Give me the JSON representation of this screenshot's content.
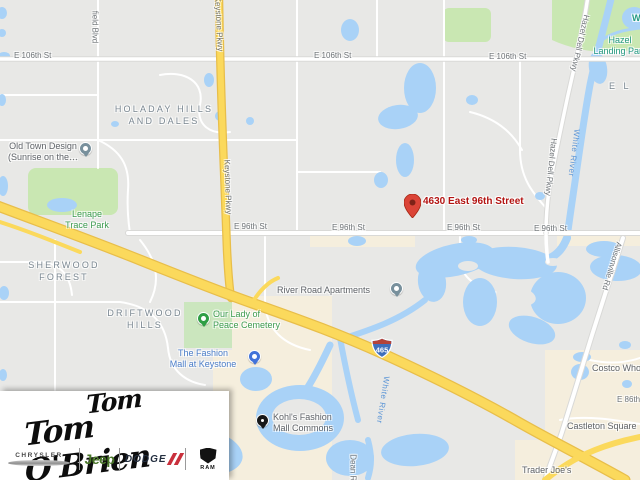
{
  "map": {
    "marker_address": "4630 East 96th Street",
    "neighborhoods": {
      "holaday": {
        "line1": "HOLADAY HILLS",
        "line2": "AND DALES"
      },
      "sherwood": {
        "line1": "SHERWOOD",
        "line2": "FOREST"
      },
      "driftwood": {
        "line1": "DRIFTWOOD",
        "line2": "HILLS"
      },
      "partial_el": "E L"
    },
    "streets": {
      "e106": "E 106th St",
      "e96": "E 96th St",
      "e86": "E 86th St",
      "keystone": "Keystone Pkwy",
      "field_blvd": "field Blvd",
      "hazel_dell": "Hazel Dell Pkwy",
      "allisonville": "Allisonville Rd",
      "dean": "Dean Rd",
      "white_river": "White River",
      "i465": "465"
    },
    "pois": {
      "old_town": {
        "line1": "Old Town Design",
        "line2": "(Sunrise on the…"
      },
      "lenape": {
        "line1": "Lenape",
        "line2": "Trace Park"
      },
      "hazel_landing": {
        "line1": "Hazel",
        "line2": "Landing Park"
      },
      "cemetery": {
        "line1": "Our Lady of",
        "line2": "Peace Cemetery"
      },
      "fashion_mall": {
        "line1": "The Fashion",
        "line2": "Mall at Keystone"
      },
      "river_road": "River Road Apartments",
      "kohls": {
        "line1": "Kohl's Fashion",
        "line2": "Mall Commons"
      },
      "trader_joes": "Trader Joe's",
      "costco": "Costco Wholesale",
      "castleton": "Castleton Square",
      "partial_w": "W"
    },
    "colors": {
      "marker_red": "#DB4437",
      "address_text": "#B31412",
      "highway_yellow": "#FBD95C",
      "water_blue": "#A9D2F7",
      "park_green": "#C9E7B2",
      "shield_blue": "#3F6FBC",
      "shield_red": "#B5433A"
    }
  },
  "dealer_logo": {
    "script_name": "Tom O'Brien",
    "brands": [
      {
        "label": "CHRYSLER"
      },
      {
        "label": "Jeep"
      },
      {
        "label": "DODGE"
      },
      {
        "label": "RAM"
      }
    ]
  }
}
